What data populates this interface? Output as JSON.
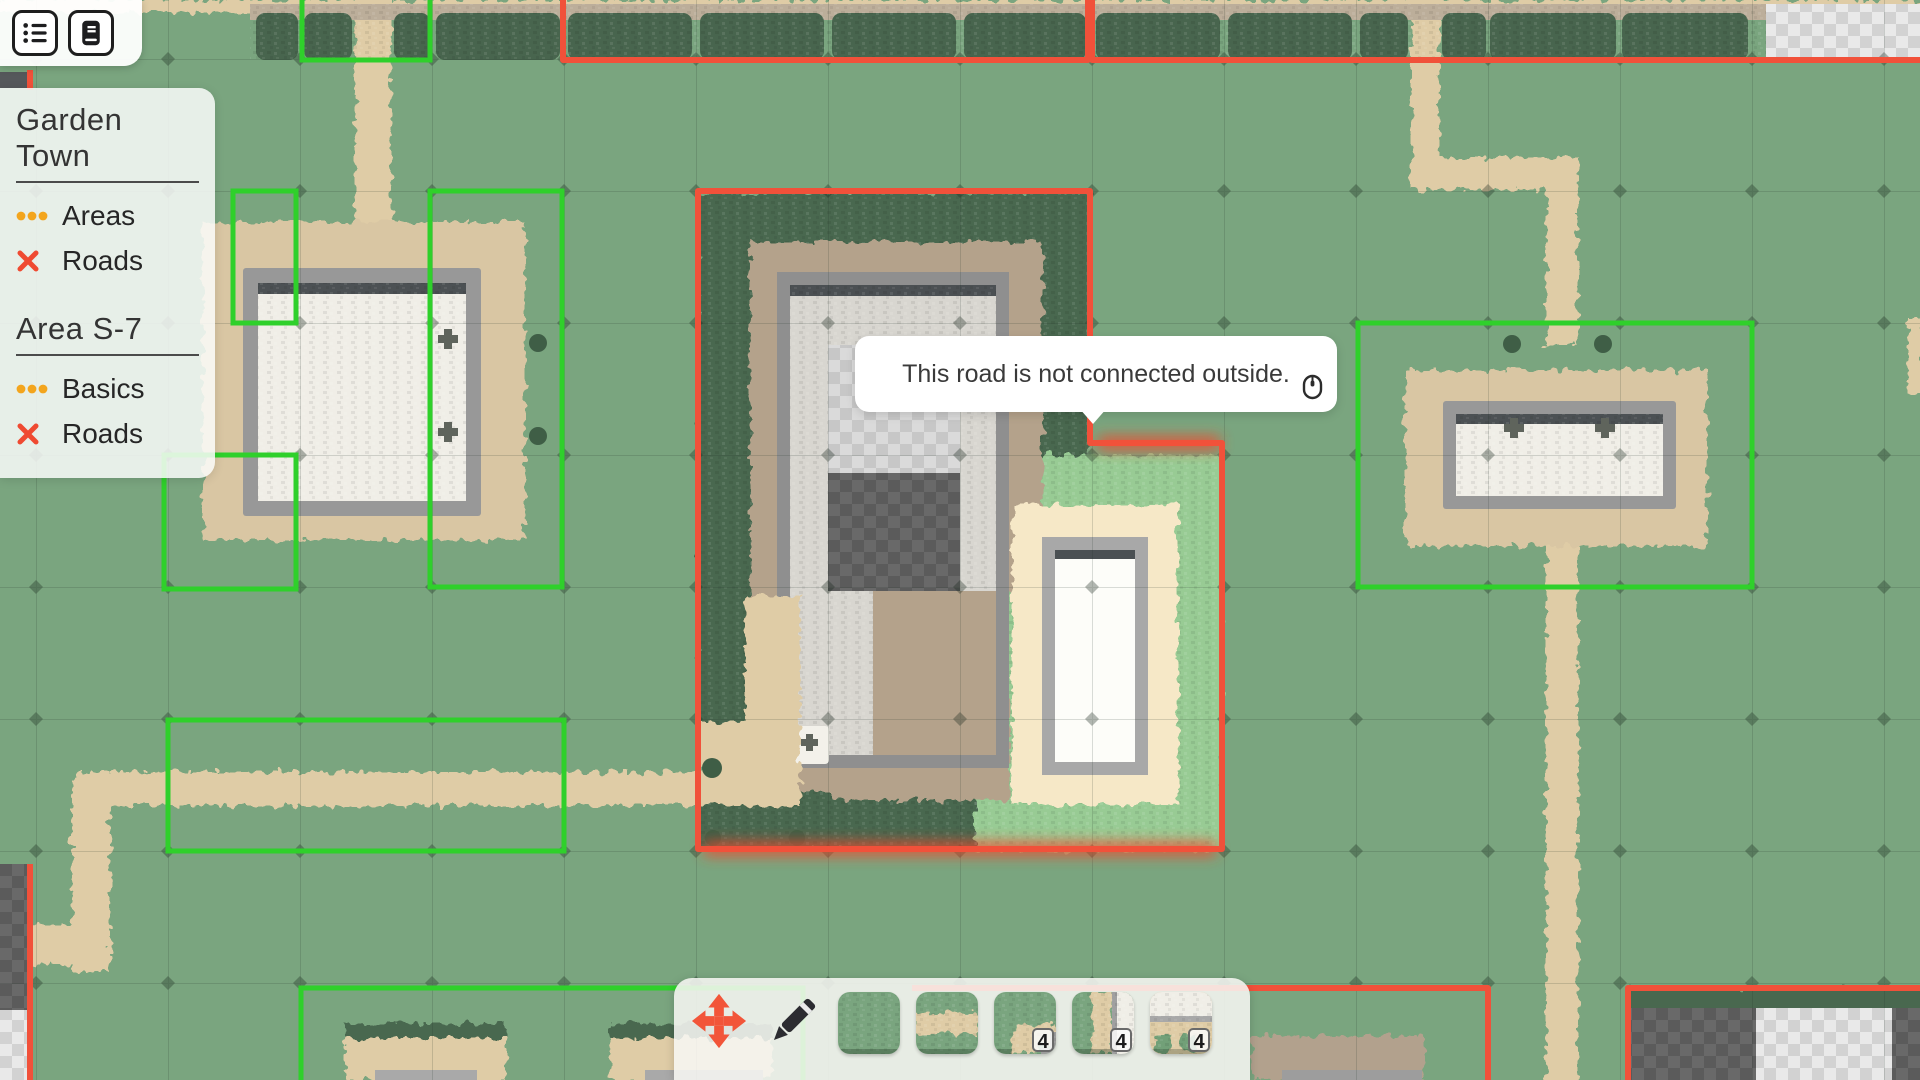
{
  "hud": {
    "menu_buttons": [
      {
        "icon": "list-icon"
      },
      {
        "icon": "journal-icon"
      }
    ],
    "legend": {
      "sections": [
        {
          "title": "Garden Town",
          "items": [
            {
              "icon": "dots-icon",
              "label": "Areas"
            },
            {
              "icon": "cross-icon",
              "label": "Roads"
            }
          ]
        },
        {
          "title": "Area S-7",
          "items": [
            {
              "icon": "dots-icon",
              "label": "Basics"
            },
            {
              "icon": "cross-icon",
              "label": "Roads"
            }
          ]
        }
      ]
    },
    "tooltip": {
      "text": "This road is not connected outside.",
      "icon": "mouse-icon"
    },
    "toolbar": {
      "active_tool": "move",
      "tools": [
        {
          "icon": "move-icon"
        },
        {
          "icon": "pencil-icon"
        }
      ],
      "tiles": [
        {
          "name": "grass",
          "count": ""
        },
        {
          "name": "road-straight",
          "count": ""
        },
        {
          "name": "road-corner",
          "count": "4"
        },
        {
          "name": "road-plaza-edge",
          "count": "4"
        },
        {
          "name": "plaza-road-stub",
          "count": "4"
        }
      ]
    }
  },
  "colors": {
    "grass": "#7aa57f",
    "hedge": "#48654e",
    "road_tan": "#dfcca6",
    "plaza_white": "#f0eee7",
    "area_ok_green": "#2fd02b",
    "area_warn_red": "#f1513a",
    "accent_orange": "#f25539",
    "legend_dots": "#f3a51d"
  }
}
